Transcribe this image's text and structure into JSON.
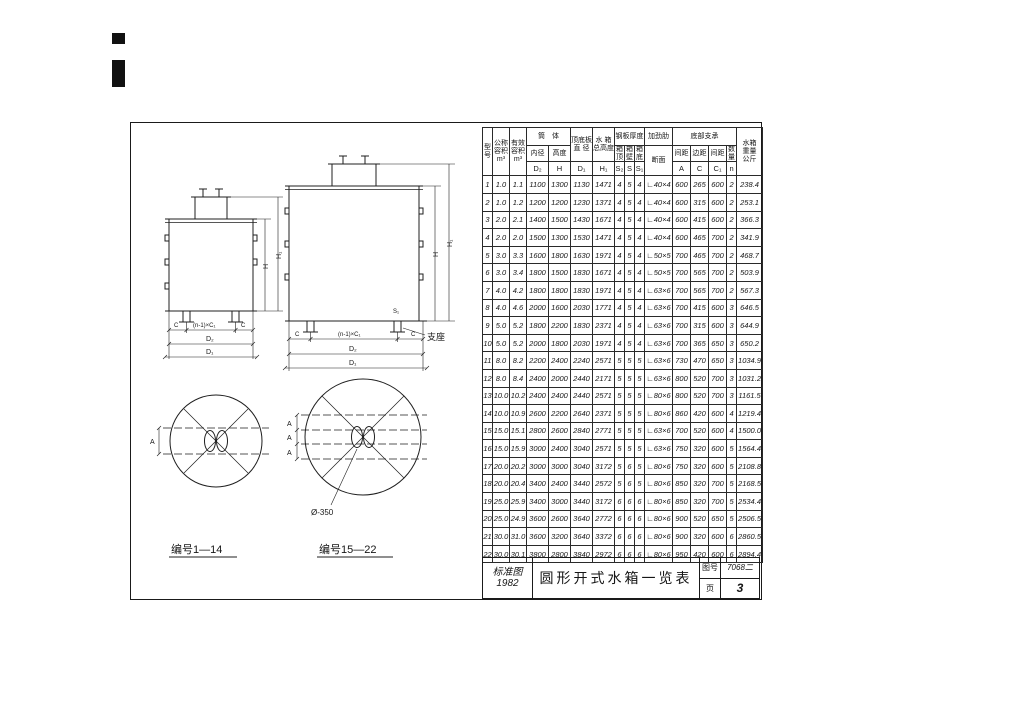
{
  "title_block": {
    "std": "标准图",
    "year": "1982",
    "title": "圆形开式水箱一览表",
    "no_label": "图号",
    "no_value": "7068二",
    "page_label": "页",
    "page_value": "3"
  },
  "drawing": {
    "caption_small": "编号1—14",
    "caption_large": "编号15—22",
    "support_label": "支座",
    "manhole_label": "Ø-350",
    "dim_c": "C",
    "dim_nc1": "(n-1)×C₁",
    "dim_d1": "D₁",
    "dim_d2": "D₂",
    "dim_h": "H",
    "dim_h1": "H₁",
    "dim_a": "A",
    "dim_s1": "S₁"
  },
  "table": {
    "col_widths": [
      10,
      17,
      17,
      22,
      22,
      22,
      22,
      10,
      10,
      10,
      28,
      18,
      18,
      18,
      10,
      26
    ],
    "thead": [
      [
        {
          "t": "型\n号",
          "rs": 3
        },
        {
          "t": "公称\n容积\nm³",
          "rs": 3
        },
        {
          "t": "有效\n容积\nm³",
          "rs": 3
        },
        {
          "t": "筒　体",
          "cs": 2
        },
        {
          "t": "顶底板\n直 径",
          "rs": 2
        },
        {
          "t": "水 箱\n总高度",
          "rs": 2
        },
        {
          "t": "钢板厚度",
          "cs": 3
        },
        {
          "t": "加劲肋"
        },
        {
          "t": "底部支承",
          "cs": 4
        },
        {
          "t": "水箱\n重量\n公斤",
          "rs": 3
        }
      ],
      [
        {
          "t": "内径"
        },
        {
          "t": "高度"
        },
        {
          "t": "箱顶"
        },
        {
          "t": "箱壁"
        },
        {
          "t": "箱底"
        },
        {
          "t": "断面",
          "rs": 2
        },
        {
          "t": "间距"
        },
        {
          "t": "边距"
        },
        {
          "t": "间距"
        },
        {
          "t": "数量"
        }
      ],
      [
        {
          "t": "D₂"
        },
        {
          "t": "H"
        },
        {
          "t": "D₁"
        },
        {
          "t": "H₁"
        },
        {
          "t": "S₂"
        },
        {
          "t": "S"
        },
        {
          "t": "S₁"
        },
        {
          "t": "A"
        },
        {
          "t": "C"
        },
        {
          "t": "C₁"
        },
        {
          "t": "n"
        }
      ]
    ],
    "rows": [
      [
        "1",
        "1.0",
        "1.1",
        "1100",
        "1300",
        "1130",
        "1471",
        "4",
        "5",
        "4",
        "∟40×4",
        "600",
        "265",
        "600",
        "2",
        "238.4"
      ],
      [
        "2",
        "1.0",
        "1.2",
        "1200",
        "1200",
        "1230",
        "1371",
        "4",
        "5",
        "4",
        "∟40×4",
        "600",
        "315",
        "600",
        "2",
        "253.1"
      ],
      [
        "3",
        "2.0",
        "2.1",
        "1400",
        "1500",
        "1430",
        "1671",
        "4",
        "5",
        "4",
        "∟40×4",
        "600",
        "415",
        "600",
        "2",
        "366.3"
      ],
      [
        "4",
        "2.0",
        "2.0",
        "1500",
        "1300",
        "1530",
        "1471",
        "4",
        "5",
        "4",
        "∟40×4",
        "600",
        "465",
        "700",
        "2",
        "341.9"
      ],
      [
        "5",
        "3.0",
        "3.3",
        "1600",
        "1800",
        "1630",
        "1971",
        "4",
        "5",
        "4",
        "∟50×5",
        "700",
        "465",
        "700",
        "2",
        "468.7"
      ],
      [
        "6",
        "3.0",
        "3.4",
        "1800",
        "1500",
        "1830",
        "1671",
        "4",
        "5",
        "4",
        "∟50×5",
        "700",
        "565",
        "700",
        "2",
        "503.9"
      ],
      [
        "7",
        "4.0",
        "4.2",
        "1800",
        "1800",
        "1830",
        "1971",
        "4",
        "5",
        "4",
        "∟63×6",
        "700",
        "565",
        "700",
        "2",
        "567.3"
      ],
      [
        "8",
        "4.0",
        "4.6",
        "2000",
        "1600",
        "2030",
        "1771",
        "4",
        "5",
        "4",
        "∟63×6",
        "700",
        "415",
        "600",
        "3",
        "646.5"
      ],
      [
        "9",
        "5.0",
        "5.2",
        "1800",
        "2200",
        "1830",
        "2371",
        "4",
        "5",
        "4",
        "∟63×6",
        "700",
        "315",
        "600",
        "3",
        "644.9"
      ],
      [
        "10",
        "5.0",
        "5.2",
        "2000",
        "1800",
        "2030",
        "1971",
        "4",
        "5",
        "4",
        "∟63×6",
        "700",
        "365",
        "650",
        "3",
        "650.2"
      ],
      [
        "11",
        "8.0",
        "8.2",
        "2200",
        "2400",
        "2240",
        "2571",
        "5",
        "5",
        "5",
        "∟63×6",
        "730",
        "470",
        "650",
        "3",
        "1034.9"
      ],
      [
        "12",
        "8.0",
        "8.4",
        "2400",
        "2000",
        "2440",
        "2171",
        "5",
        "5",
        "5",
        "∟63×6",
        "800",
        "520",
        "700",
        "3",
        "1031.2"
      ],
      [
        "13",
        "10.0",
        "10.2",
        "2400",
        "2400",
        "2440",
        "2571",
        "5",
        "5",
        "5",
        "∟80×6",
        "800",
        "520",
        "700",
        "3",
        "1161.5"
      ],
      [
        "14",
        "10.0",
        "10.9",
        "2600",
        "2200",
        "2640",
        "2371",
        "5",
        "5",
        "5",
        "∟80×6",
        "860",
        "420",
        "600",
        "4",
        "1219.4"
      ],
      [
        "15",
        "15.0",
        "15.1",
        "2800",
        "2600",
        "2840",
        "2771",
        "5",
        "5",
        "5",
        "∟63×6",
        "700",
        "520",
        "600",
        "4",
        "1500.0"
      ],
      [
        "16",
        "15.0",
        "15.9",
        "3000",
        "2400",
        "3040",
        "2571",
        "5",
        "5",
        "5",
        "∟63×6",
        "750",
        "320",
        "600",
        "5",
        "1564.4"
      ],
      [
        "17",
        "20.0",
        "20.2",
        "3000",
        "3000",
        "3040",
        "3172",
        "5",
        "6",
        "5",
        "∟80×6",
        "750",
        "320",
        "600",
        "5",
        "2108.8"
      ],
      [
        "18",
        "20.0",
        "20.4",
        "3400",
        "2400",
        "3440",
        "2572",
        "5",
        "6",
        "5",
        "∟80×6",
        "850",
        "320",
        "700",
        "5",
        "2168.5"
      ],
      [
        "19",
        "25.0",
        "25.9",
        "3400",
        "3000",
        "3440",
        "3172",
        "6",
        "6",
        "6",
        "∟80×6",
        "850",
        "320",
        "700",
        "5",
        "2534.4"
      ],
      [
        "20",
        "25.0",
        "24.9",
        "3600",
        "2600",
        "3640",
        "2772",
        "6",
        "6",
        "6",
        "∟80×6",
        "900",
        "520",
        "650",
        "5",
        "2506.5"
      ],
      [
        "21",
        "30.0",
        "31.0",
        "3600",
        "3200",
        "3640",
        "3372",
        "6",
        "6",
        "6",
        "∟80×6",
        "900",
        "320",
        "600",
        "6",
        "2860.5"
      ],
      [
        "22",
        "30.0",
        "30.1",
        "3800",
        "2800",
        "3840",
        "2972",
        "6",
        "6",
        "6",
        "∟80×6",
        "950",
        "420",
        "600",
        "6",
        "2894.4"
      ]
    ]
  }
}
